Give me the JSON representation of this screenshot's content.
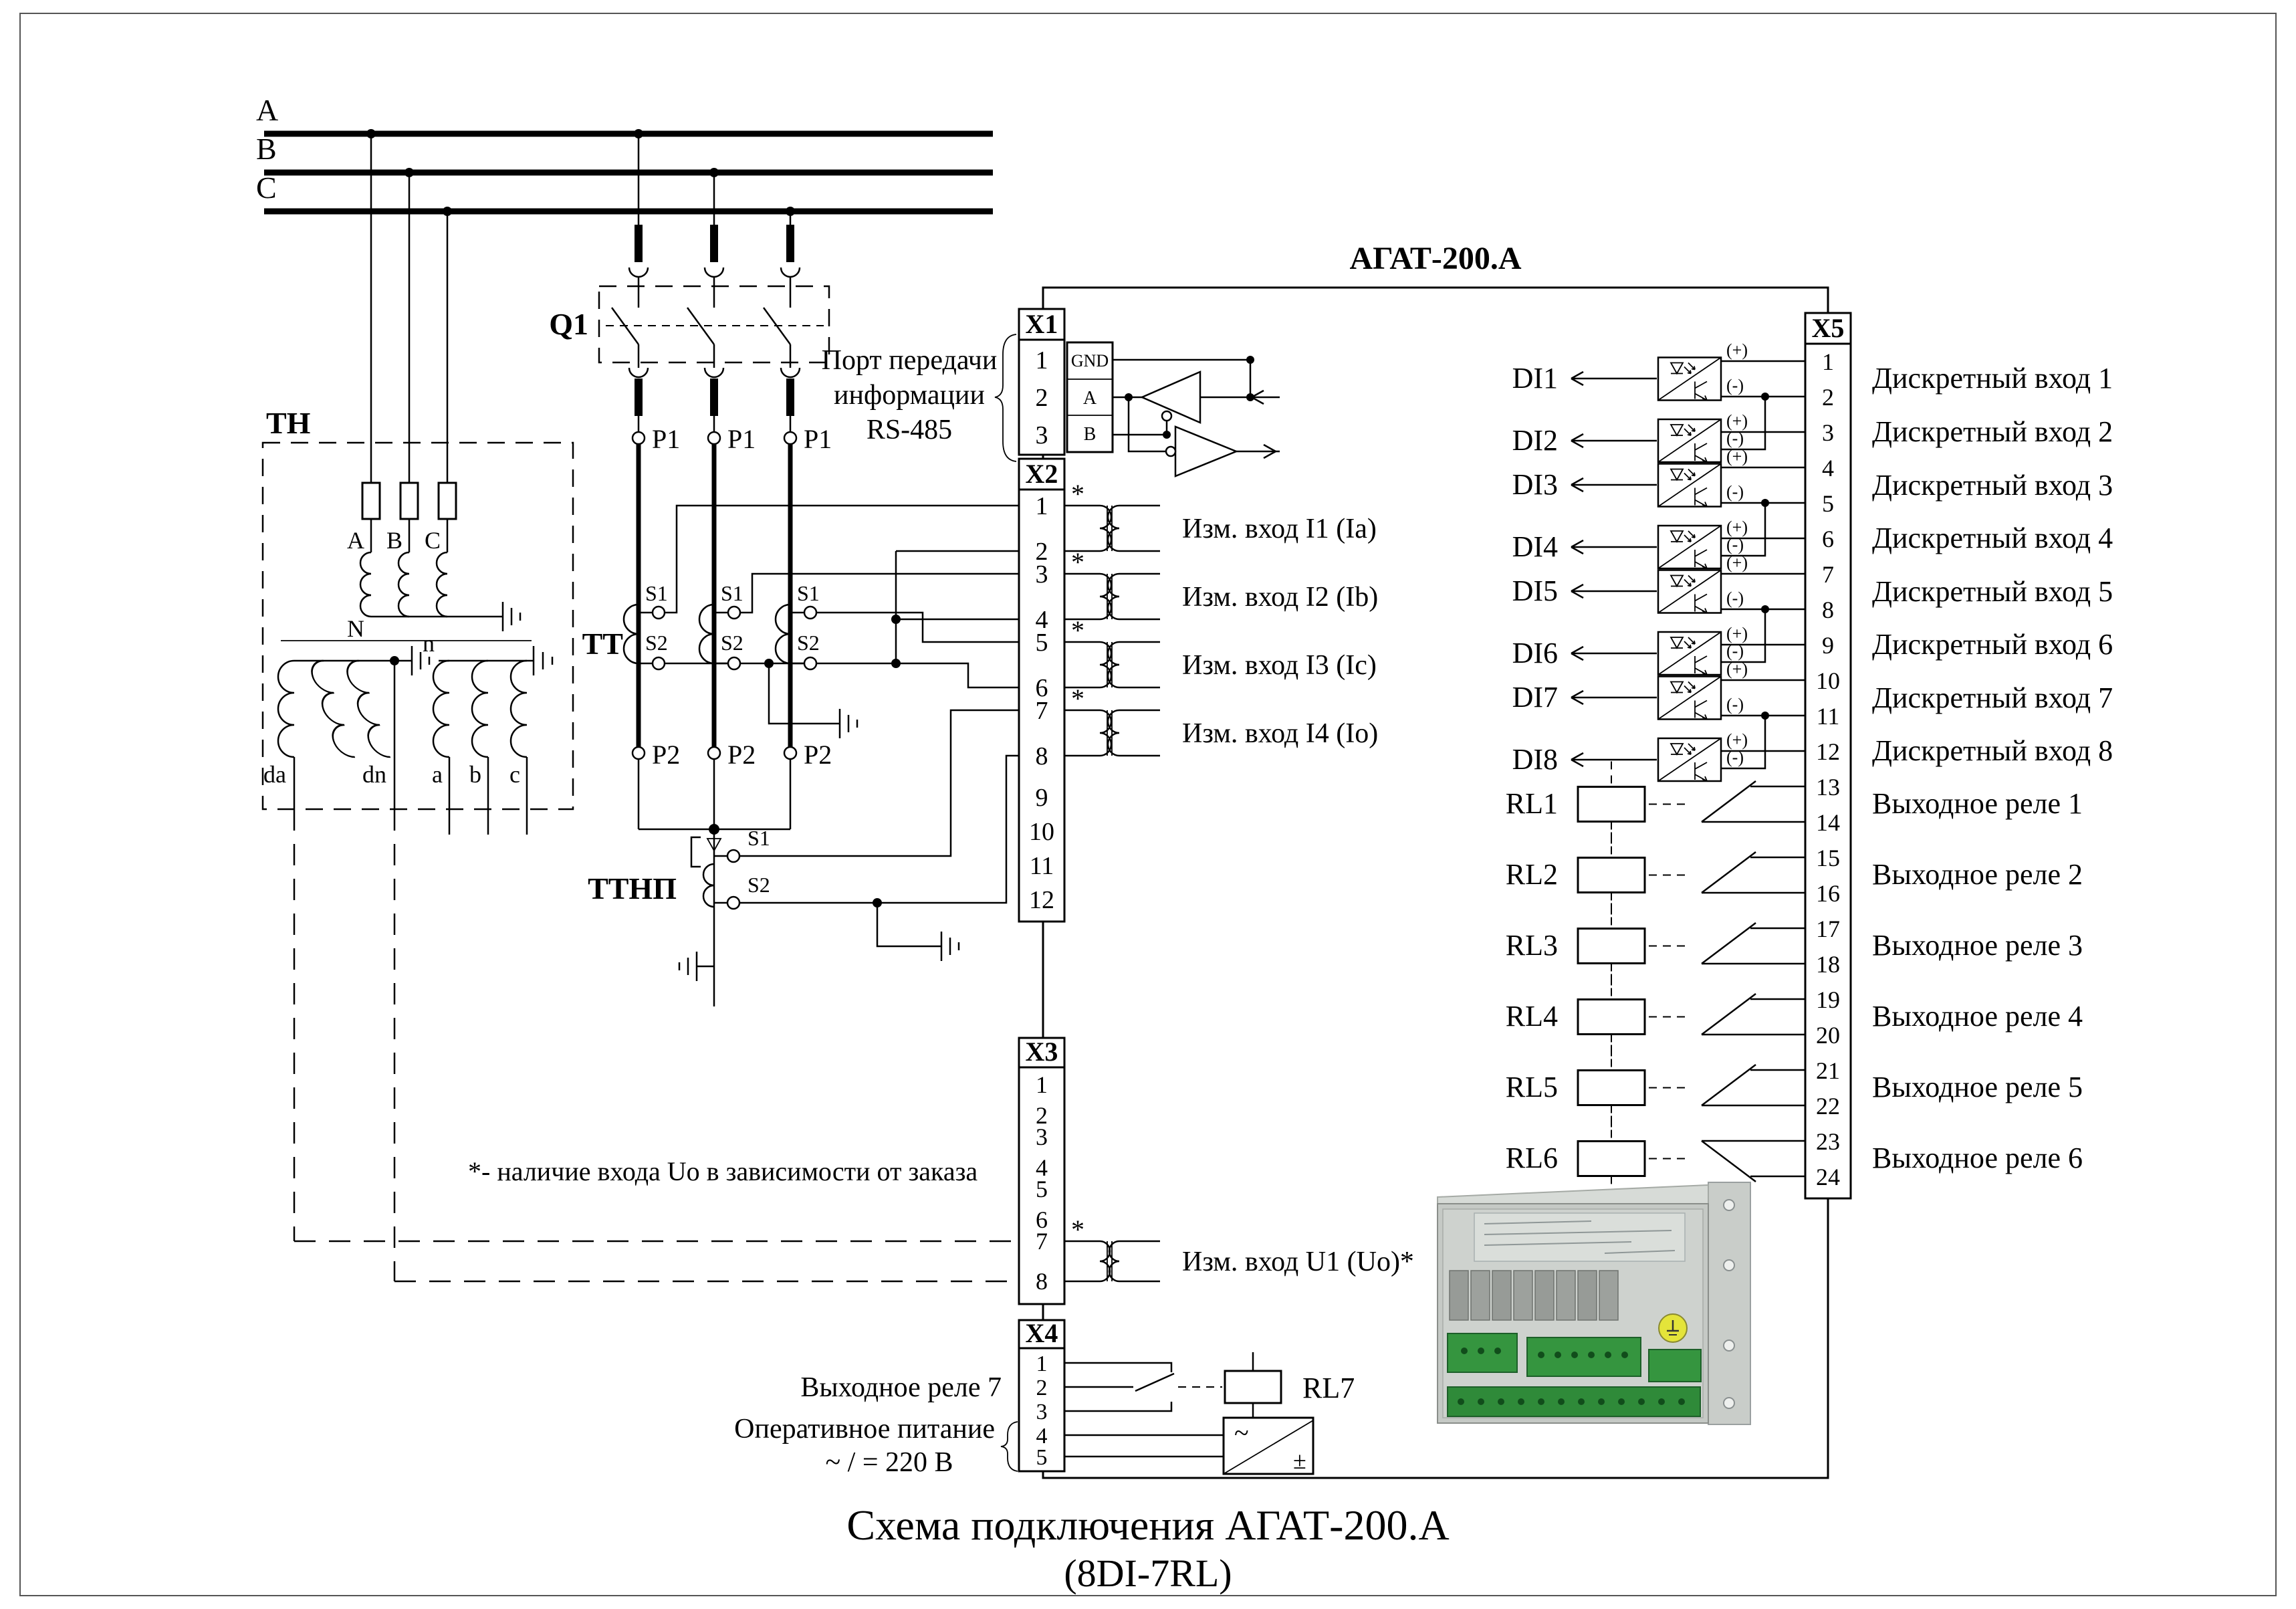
{
  "device": {
    "name": "АГАТ-200.А"
  },
  "caption": {
    "line1": "Схема подключения АГАТ-200.А",
    "line2": "(8DI-7RL)"
  },
  "note": "*- наличие входа Uo в зависимости от заказа",
  "buses": {
    "a": "A",
    "b": "B",
    "c": "C"
  },
  "q1": {
    "label": "Q1"
  },
  "tn": {
    "label": "ТН",
    "phase_a": "A",
    "phase_b": "B",
    "phase_c": "C",
    "n": "N",
    "n_small": "n",
    "da": "da",
    "dn": "dn",
    "a": "a",
    "b": "b",
    "c": "c"
  },
  "tt": {
    "label": "ТТ",
    "p1": "P1",
    "p2": "P2",
    "s1": "S1",
    "s2": "S2"
  },
  "ttnp": {
    "label": "ТТНП",
    "s1": "S1",
    "s2": "S2"
  },
  "x1": {
    "label": "X1",
    "pins": [
      "1",
      "2",
      "3"
    ],
    "pin_labels": [
      "GND",
      "A",
      "B"
    ],
    "caption_line1": "Порт передачи",
    "caption_line2": "информации",
    "caption_line3": "RS-485"
  },
  "x2": {
    "label": "X2",
    "asterisk": "*",
    "pins": [
      "1",
      "2",
      "3",
      "4",
      "5",
      "6",
      "7",
      "8",
      "9",
      "10",
      "11",
      "12"
    ],
    "inputs": [
      "Изм. вход I1 (Ia)",
      "Изм. вход I2 (Ib)",
      "Изм. вход I3 (Ic)",
      "Изм. вход I4 (Io)"
    ]
  },
  "x3": {
    "label": "X3",
    "asterisk": "*",
    "pins": [
      "1",
      "2",
      "3",
      "4",
      "5",
      "6",
      "7",
      "8"
    ],
    "input": "Изм. вход U1 (Uo)*"
  },
  "x4": {
    "label": "X4",
    "pins": [
      "1",
      "2",
      "3",
      "4",
      "5"
    ],
    "relay_label": "Выходное реле 7",
    "rl7": "RL7",
    "power_line1": "Оперативное питание",
    "power_line2": "~ / = 220 В"
  },
  "x5": {
    "label": "X5",
    "plus": "(+)",
    "minus": "(-)",
    "pins": [
      "1",
      "2",
      "3",
      "4",
      "5",
      "6",
      "7",
      "8",
      "9",
      "10",
      "11",
      "12",
      "13",
      "14",
      "15",
      "16",
      "17",
      "18",
      "19",
      "20",
      "21",
      "22",
      "23",
      "24"
    ],
    "di": [
      {
        "tag": "DI1",
        "label": "Дискретный вход 1"
      },
      {
        "tag": "DI2",
        "label": "Дискретный вход 2"
      },
      {
        "tag": "DI3",
        "label": "Дискретный вход 3"
      },
      {
        "tag": "DI4",
        "label": "Дискретный вход 4"
      },
      {
        "tag": "DI5",
        "label": "Дискретный вход 5"
      },
      {
        "tag": "DI6",
        "label": "Дискретный вход 6"
      },
      {
        "tag": "DI7",
        "label": "Дискретный вход 7"
      },
      {
        "tag": "DI8",
        "label": "Дискретный вход 8"
      }
    ],
    "relays": [
      {
        "tag": "RL1",
        "label": "Выходное реле 1"
      },
      {
        "tag": "RL2",
        "label": "Выходное реле 2"
      },
      {
        "tag": "RL3",
        "label": "Выходное реле 3"
      },
      {
        "tag": "RL4",
        "label": "Выходное реле 4"
      },
      {
        "tag": "RL5",
        "label": "Выходное реле 5"
      },
      {
        "tag": "RL6",
        "label": "Выходное реле 6"
      }
    ]
  }
}
